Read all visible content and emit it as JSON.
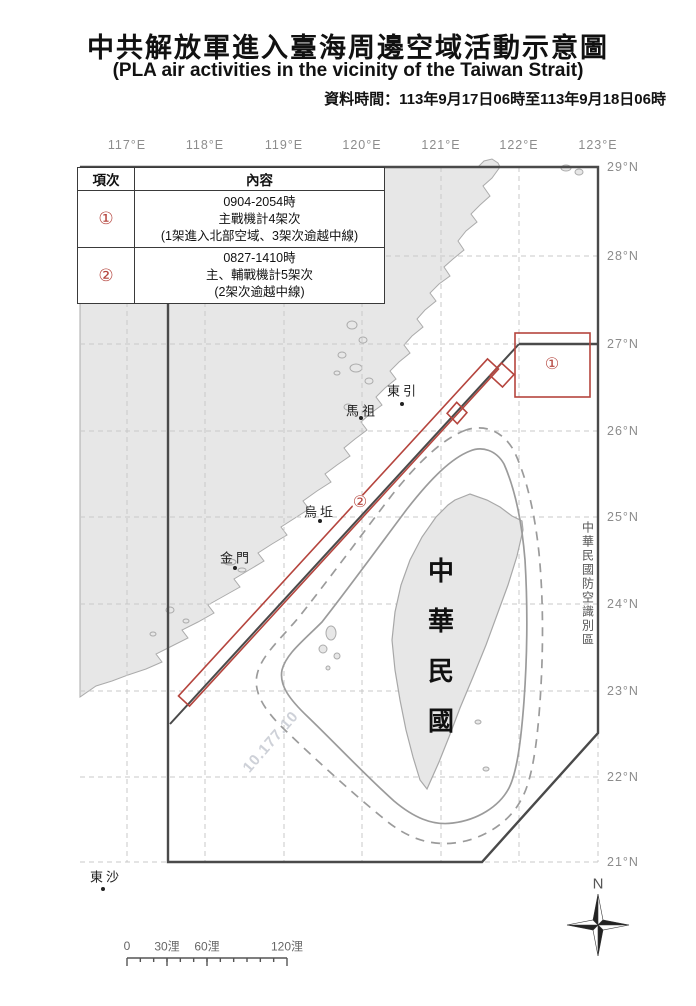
{
  "page": {
    "title": "中共解放軍進入臺海周邊空域活動示意圖",
    "subtitle": "(PLA air activities in the vicinity of the Taiwan Strait)",
    "data_time": "資料時間：113年9月17日06時至113年9月18日06時"
  },
  "table": {
    "headers": [
      "項次",
      "內容"
    ],
    "rows": [
      {
        "num": "①",
        "lines": [
          "0904-2054時",
          "主戰機計4架次",
          "(1架進入北部空域、3架次逾越中線)"
        ]
      },
      {
        "num": "②",
        "lines": [
          "0827-1410時",
          "主、輔戰機計5架次",
          "(2架次逾越中線)"
        ]
      }
    ]
  },
  "axis": {
    "lon": [
      "117°E",
      "118°E",
      "119°E",
      "120°E",
      "121°E",
      "122°E",
      "123°E"
    ],
    "lat": [
      "29°N",
      "28°N",
      "27°N",
      "26°N",
      "25°N",
      "24°N",
      "23°N",
      "22°N",
      "21°N"
    ]
  },
  "map": {
    "labels": {
      "dongyin": "東引",
      "mazu": "馬祖",
      "wuqiu": "烏坵",
      "kinmen": "金門",
      "dongsha": "東沙"
    },
    "taiwan_chars": [
      "中",
      "華",
      "民",
      "國"
    ],
    "adiz_label": "中華民國防空識別區",
    "marker1": "①",
    "marker2": "②",
    "compass_n": "N",
    "watermark": "10.177.10"
  },
  "scalebar": {
    "labels": [
      "0",
      "30浬",
      "60浬",
      "120浬"
    ]
  },
  "colors": {
    "red": "#b5453e",
    "dark_boundary": "#4a4a4a",
    "land": "#e7e7e7",
    "grid": "#c9c9c9",
    "ring": "#9b9b9b",
    "axis_label": "#8c8c8c"
  }
}
